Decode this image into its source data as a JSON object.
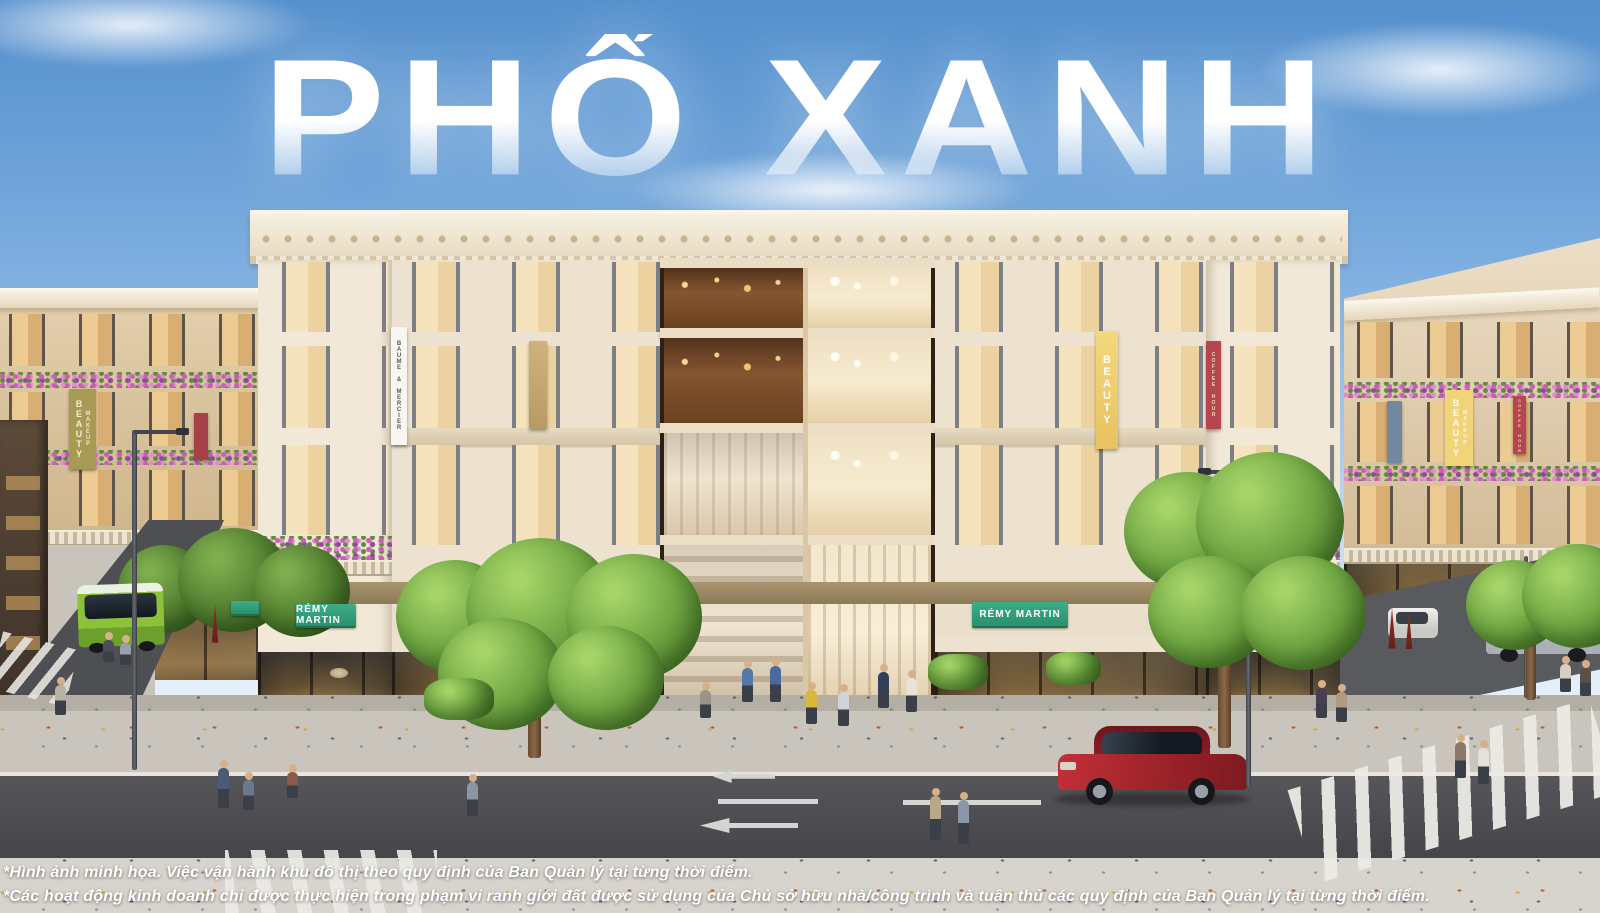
{
  "title": "PHỐ XANH",
  "disclaimers": {
    "line1": "*Hình ảnh minh họa. Việc vận hành khu đô thị theo quy định của Ban Quản lý tại từng thời điểm.",
    "line2": "*Các hoạt động kinh doanh chỉ được thực hiện trong phạm vi ranh giới đất được sử dụng của Chủ sở hữu nhà/công trình và tuân thủ các quy định của Ban Quản lý tại từng thời điểm."
  },
  "signs": {
    "remy_left": "RÉMY MARTIN",
    "coffee_house": "COFFEE HOUS",
    "remy_right": "RÉMY MARTIN"
  },
  "banners": {
    "baume_mercier": "BAUME & MERCIER",
    "beauty": "BEAUTY",
    "makeup": "MAKEUP",
    "coffee_hour": "COFFEE HOUR"
  },
  "colors": {
    "sky_top": "#5590cd",
    "sky_horizon": "#ecf4fa",
    "facade_cream": "#ece2cf",
    "sign_green": "#2fa27e",
    "sign_coffee_bg": "#54202d",
    "sign_coffee_text": "#f08aa8",
    "banner_olive": "#a79a55",
    "banner_yellow": "#f0d06e",
    "banner_red": "#b5454e",
    "bus_green": "#7fba33",
    "car_red": "#a8232a",
    "title_white": "#ffffff"
  }
}
